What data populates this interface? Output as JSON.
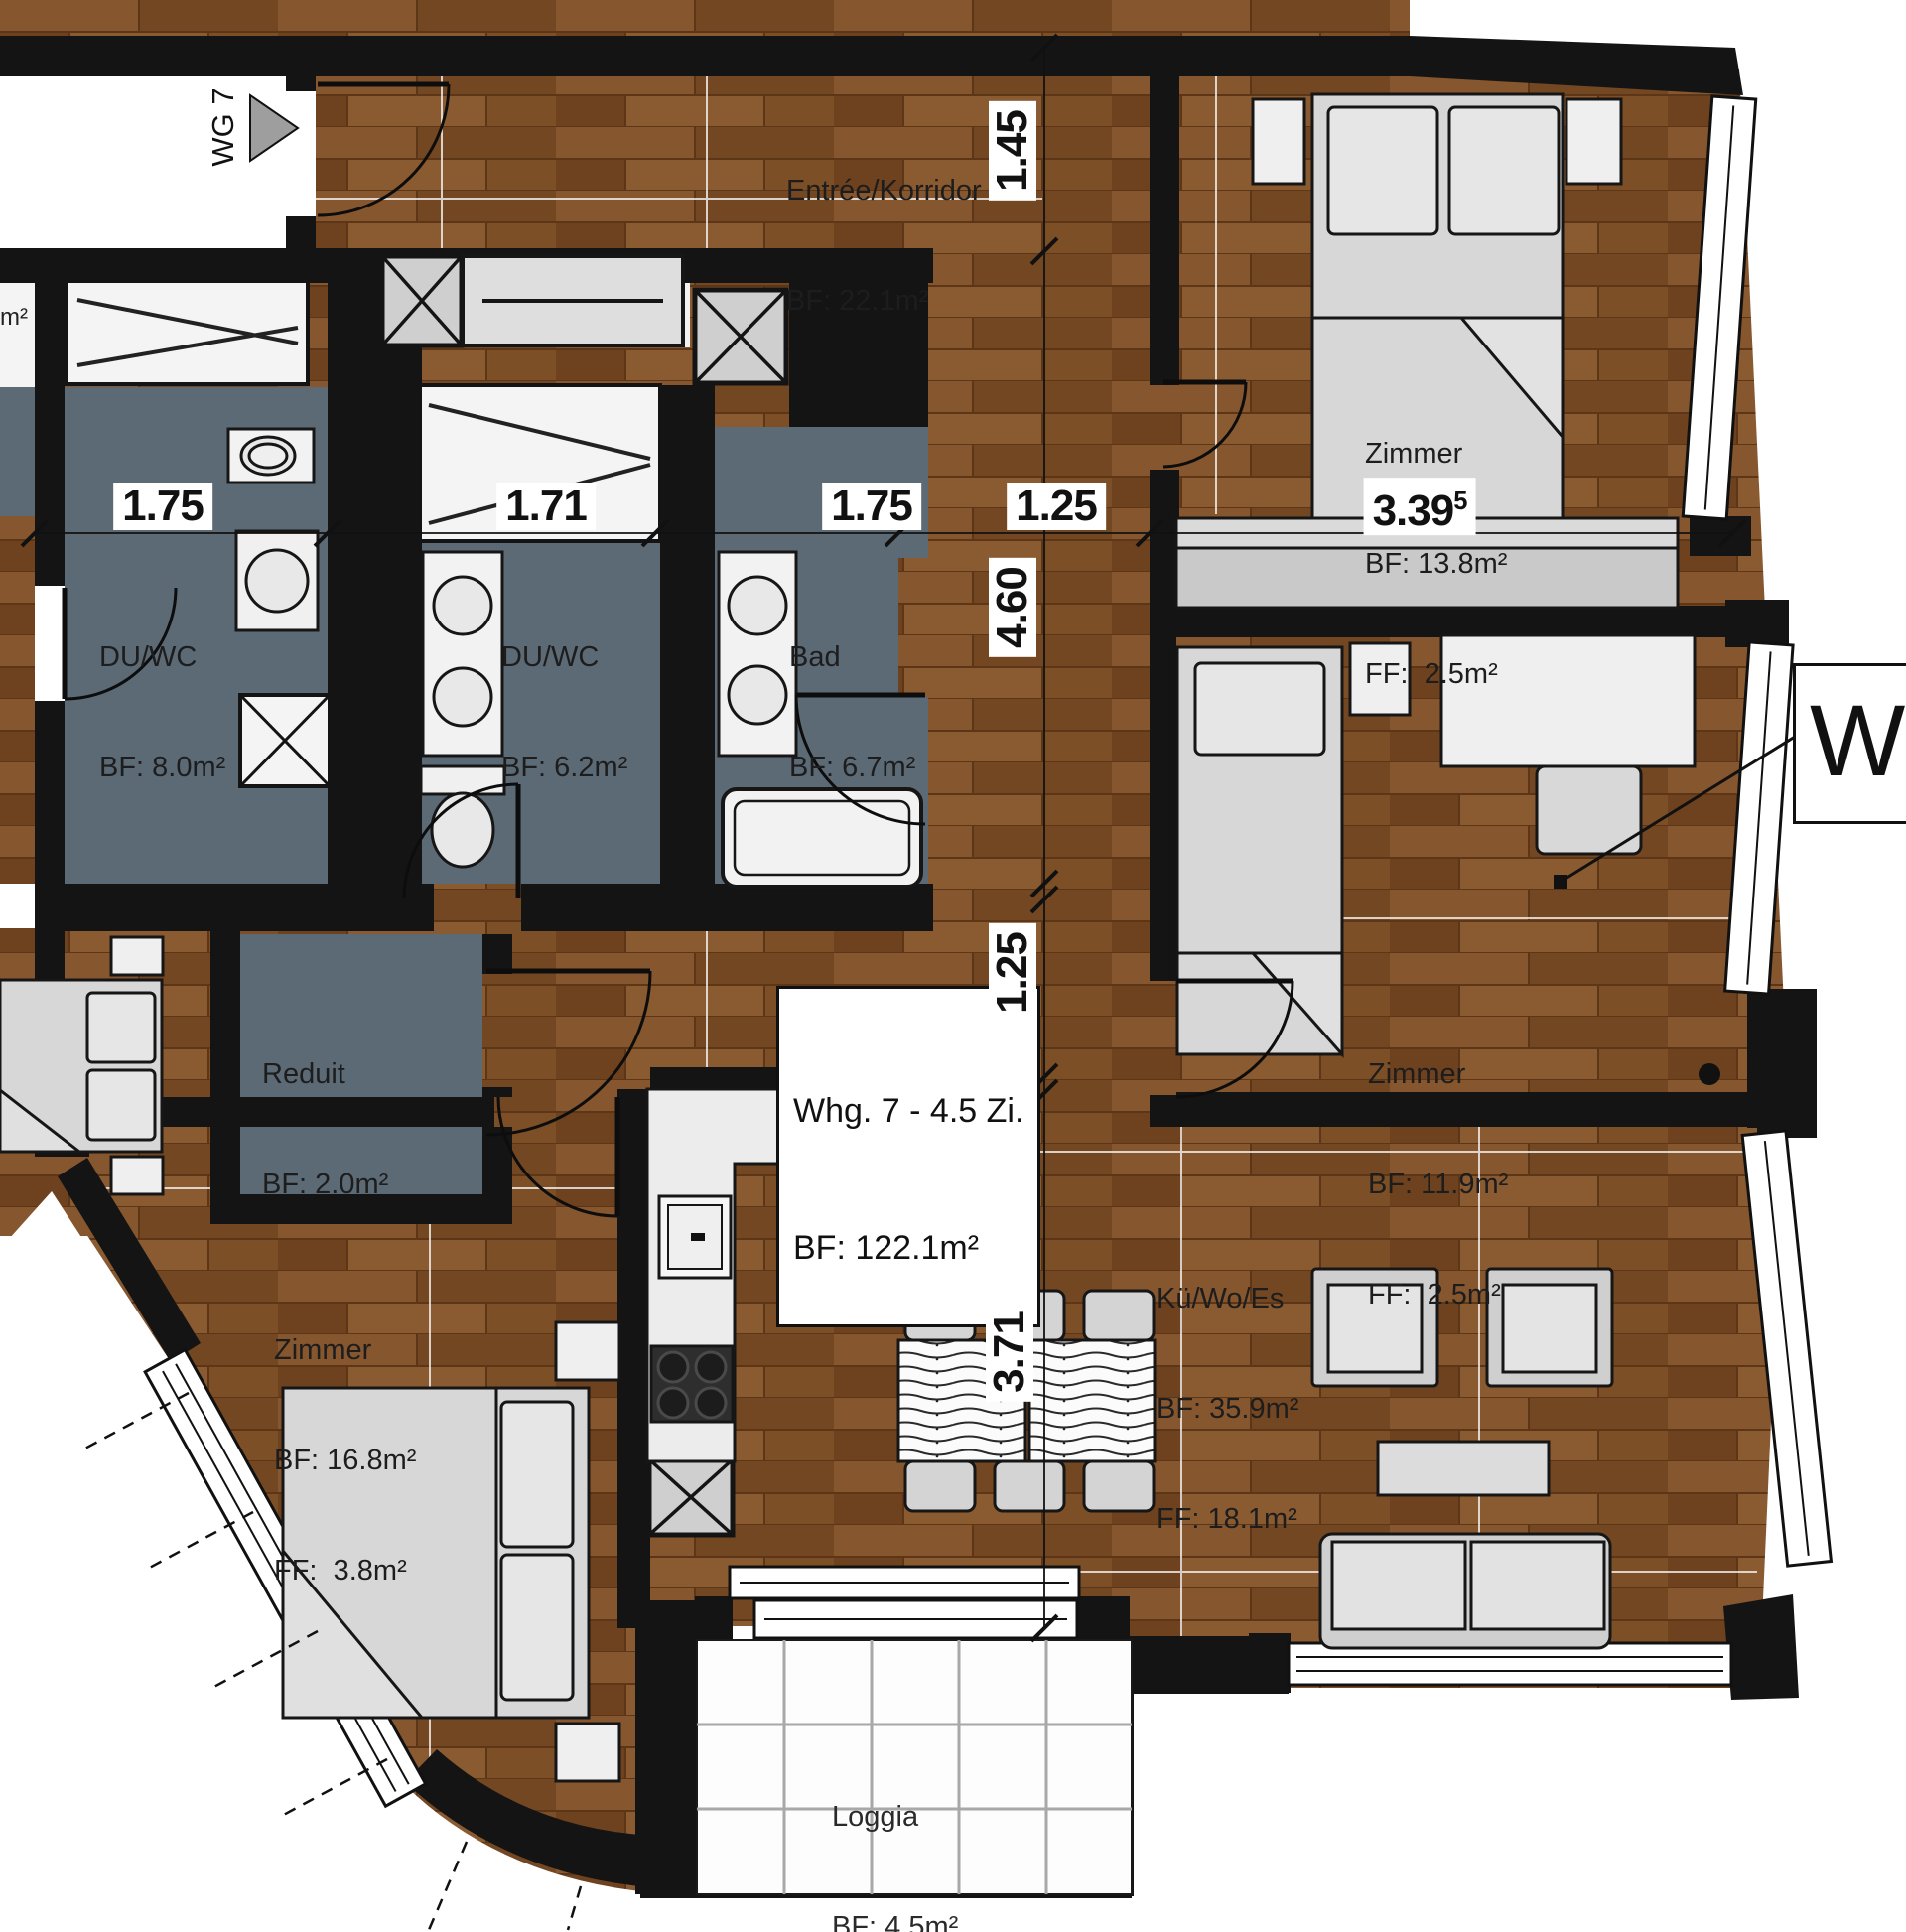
{
  "apartment": {
    "box_line1": "Whg. 7 - 4.5 Zi.",
    "box_line2": "BF: 122.1m²",
    "entrance_tag": "WG 7",
    "external_tag": "WE",
    "edge_fragment": "m²"
  },
  "rooms": {
    "entree": {
      "name": "Entrée/Korridor",
      "bf": "BF: 22.1m²"
    },
    "zimmer_nord": {
      "name": "Zimmer",
      "bf": "BF: 13.8m²",
      "ff": "FF:  2.5m²"
    },
    "zimmer_ost": {
      "name": "Zimmer",
      "bf": "BF: 11.9m²",
      "ff": "FF:  2.5m²"
    },
    "zimmer_sued": {
      "name": "Zimmer",
      "bf": "BF: 16.8m²",
      "ff": "FF:  3.8m²"
    },
    "wohnen": {
      "name": "Kü/Wo/Es",
      "bf": "BF: 35.9m²",
      "ff": "FF: 18.1m²"
    },
    "duwc1": {
      "name": "DU/WC",
      "bf": "BF: 8.0m²"
    },
    "duwc2": {
      "name": "DU/WC",
      "bf": "BF: 6.2m²"
    },
    "bad": {
      "name": "Bad",
      "bf": "BF: 6.7m²"
    },
    "reduit": {
      "name": "Reduit",
      "bf": "BF: 2.0m²"
    },
    "loggia": {
      "name": "Loggia",
      "bf": "BF: 4.5m²"
    }
  },
  "dimensions": {
    "horizontal": {
      "d1": "1.75",
      "d2": "1.71",
      "d3": "1.75",
      "d4": "1.25",
      "d5": "3.39",
      "d5_sup": "5"
    },
    "vertical": {
      "v1": "1.45",
      "v2": "4.60",
      "v3": "1.25",
      "v4": "3.71"
    }
  },
  "colors": {
    "wood": "#7c4e27",
    "wet_floor": "#5c6a76",
    "wall": "#141414",
    "furniture": "#d7d7d7",
    "wardrobe": "#c9c9c9",
    "white": "#ffffff"
  }
}
